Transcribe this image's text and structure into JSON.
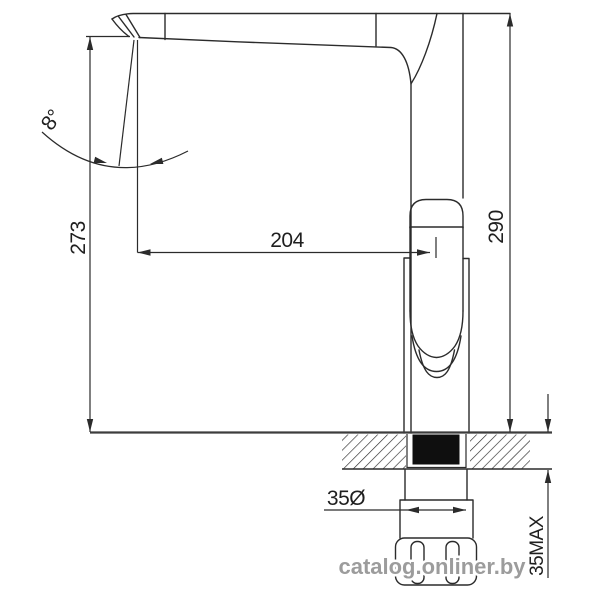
{
  "drawing": {
    "type": "faucet-technical-dimension-diagram",
    "labels": {
      "overall_height_left": "273",
      "spout_reach": "204",
      "overall_height_right": "290",
      "swivel_angle": "8°",
      "mount_hole_diameter": "35Ø",
      "deck_thickness_max": "35MAX"
    },
    "watermark": "catalog.onliner.by",
    "colors": {
      "line": "#2b2b2b",
      "deck_line": "#3d3d3d",
      "seal_fill": "#0f0f0f",
      "watermark_text": "#9c9c9c",
      "background": "#ffffff"
    }
  }
}
